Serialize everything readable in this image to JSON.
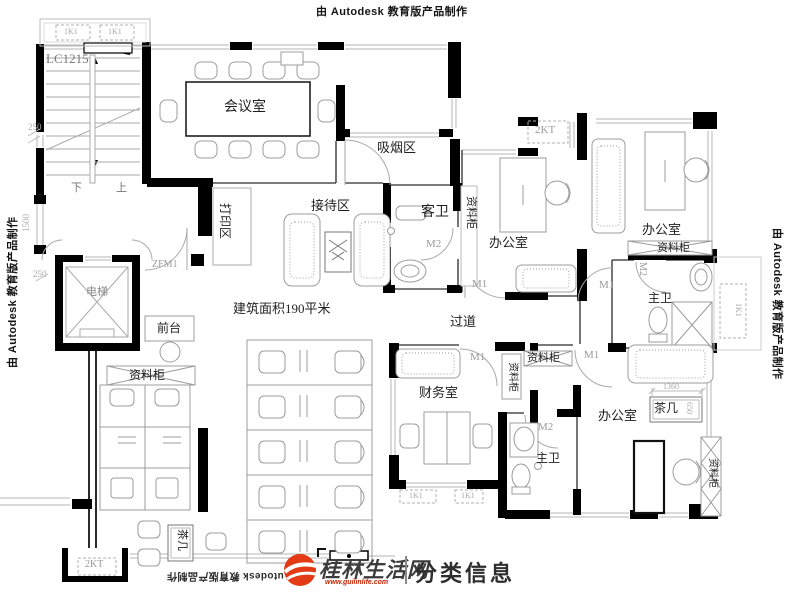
{
  "watermarks": {
    "autodesk_text": "由 Autodesk 教育版产品制作"
  },
  "logo": {
    "site_name": "桂林生活网",
    "site_url": "www.guilinlife.com",
    "tagline": "分类信息",
    "brand_red": "#e23b16"
  },
  "plan": {
    "area_note": "建筑面积190平米",
    "window_code": "LC1215",
    "labels": [
      {
        "id": "window-code-lc1215",
        "t": "LC1215",
        "x": 46,
        "y": 52,
        "s": 13,
        "c": "#777"
      },
      {
        "id": "room-conference",
        "t": "会议室",
        "x": 224,
        "y": 101,
        "s": 14
      },
      {
        "id": "area-smoking",
        "t": "吸烟区",
        "x": 377,
        "y": 141,
        "s": 13
      },
      {
        "id": "area-reception",
        "t": "接待区",
        "x": 311,
        "y": 199,
        "s": 13
      },
      {
        "id": "area-print",
        "t": "打印区",
        "x": 231,
        "y": 203,
        "s": 12,
        "r": 90
      },
      {
        "id": "door-zfm1",
        "t": "ZFM1",
        "x": 152,
        "y": 260,
        "s": 10,
        "c": "#999"
      },
      {
        "id": "room-guest-bath",
        "t": "客卫",
        "x": 421,
        "y": 206,
        "s": 14
      },
      {
        "id": "door-m2-guest-bath",
        "t": "M2",
        "x": 426,
        "y": 239,
        "s": 11,
        "c": "#999"
      },
      {
        "id": "elevator-label",
        "t": "电梯",
        "x": 86,
        "y": 287,
        "s": 11,
        "c": "#888"
      },
      {
        "id": "dim-250-upper",
        "t": "250",
        "x": 28,
        "y": 123,
        "s": 9,
        "c": "#aaa"
      },
      {
        "id": "dim-1500",
        "t": "1500",
        "x": 22,
        "y": 232,
        "s": 9,
        "c": "#aaa",
        "r": -90
      },
      {
        "id": "dim-250-lower",
        "t": "250",
        "x": 33,
        "y": 270,
        "s": 9,
        "c": "#aaa"
      },
      {
        "id": "stair-down",
        "t": "下",
        "x": 71,
        "y": 183,
        "s": 11,
        "c": "#777"
      },
      {
        "id": "stair-up",
        "t": "上",
        "x": 116,
        "y": 183,
        "s": 11,
        "c": "#777"
      },
      {
        "id": "front-desk-label",
        "t": "前台",
        "x": 157,
        "y": 322,
        "s": 12
      },
      {
        "id": "cabinet-lobby",
        "t": "资料柜",
        "x": 129,
        "y": 369,
        "s": 12
      },
      {
        "id": "area-note",
        "t": "建筑面积190平米",
        "x": 233,
        "y": 302,
        "s": 13
      },
      {
        "id": "corridor-label",
        "t": "过道",
        "x": 450,
        "y": 315,
        "s": 13
      },
      {
        "id": "room-office-1",
        "t": "办公室",
        "x": 489,
        "y": 236,
        "s": 13
      },
      {
        "id": "cabinet-office-1",
        "t": "资料柜",
        "x": 476,
        "y": 196,
        "s": 11,
        "r": 90
      },
      {
        "id": "ac-2kt-top",
        "t": "2KT",
        "x": 535,
        "y": 125,
        "s": 11,
        "c": "#999"
      },
      {
        "id": "room-office-2",
        "t": "办公室",
        "x": 642,
        "y": 223,
        "s": 13
      },
      {
        "id": "cabinet-office-2",
        "t": "资料柜",
        "x": 657,
        "y": 243,
        "s": 11
      },
      {
        "id": "door-m1-office-1",
        "t": "M1",
        "x": 472,
        "y": 279,
        "s": 11,
        "c": "#999"
      },
      {
        "id": "door-m1-bath-1",
        "t": "M1",
        "x": 599,
        "y": 280,
        "s": 11,
        "c": "#999"
      },
      {
        "id": "door-m2-bath-1",
        "t": "M2",
        "x": 647,
        "y": 262,
        "s": 10,
        "c": "#999",
        "r": 90
      },
      {
        "id": "room-master-bath-1",
        "t": "主卫",
        "x": 648,
        "y": 292,
        "s": 12
      },
      {
        "id": "door-m1-finance",
        "t": "M1",
        "x": 470,
        "y": 352,
        "s": 11,
        "c": "#999"
      },
      {
        "id": "room-finance",
        "t": "财务室",
        "x": 419,
        "y": 386,
        "s": 13
      },
      {
        "id": "cabinet-corridor-vert",
        "t": "资料柜",
        "x": 517,
        "y": 362,
        "s": 10,
        "r": 90
      },
      {
        "id": "cabinet-corridor-horiz",
        "t": "资料柜",
        "x": 527,
        "y": 353,
        "s": 11
      },
      {
        "id": "door-m1-corridor",
        "t": "M1",
        "x": 584,
        "y": 350,
        "s": 11,
        "c": "#999"
      },
      {
        "id": "door-m2-bath-2",
        "t": "M2",
        "x": 538,
        "y": 422,
        "s": 11,
        "c": "#999"
      },
      {
        "id": "room-master-bath-2",
        "t": "主卫",
        "x": 536,
        "y": 452,
        "s": 12
      },
      {
        "id": "room-office-3",
        "t": "办公室",
        "x": 598,
        "y": 409,
        "s": 13
      },
      {
        "id": "tea-table-office-3",
        "t": "茶几",
        "x": 654,
        "y": 402,
        "s": 12
      },
      {
        "id": "dim-1360",
        "t": "1360",
        "x": 663,
        "y": 383,
        "s": 8,
        "c": "#aaa"
      },
      {
        "id": "dim-650",
        "t": "650",
        "x": 693,
        "y": 402,
        "s": 8,
        "c": "#aaa",
        "r": 90
      },
      {
        "id": "cabinet-office-3",
        "t": "资料柜",
        "x": 717,
        "y": 458,
        "s": 10,
        "r": 90
      },
      {
        "id": "tea-table-lobby",
        "t": "茶几",
        "x": 187,
        "y": 529,
        "s": 11,
        "r": 90
      },
      {
        "id": "ac-2kt-bottom",
        "t": "2KT",
        "x": 85,
        "y": 560,
        "s": 10,
        "c": "#999"
      },
      {
        "id": "ac-1k1-balcony-a",
        "t": "1K1",
        "x": 64,
        "y": 28,
        "s": 8,
        "c": "#aaa"
      },
      {
        "id": "ac-1k1-balcony-b",
        "t": "1K1",
        "x": 108,
        "y": 28,
        "s": 8,
        "c": "#aaa"
      },
      {
        "id": "ac-1k1-right",
        "t": "1K1",
        "x": 742,
        "y": 303,
        "s": 8,
        "c": "#aaa",
        "r": 90
      },
      {
        "id": "ac-1k1-finance-a",
        "t": "1K1",
        "x": 409,
        "y": 492,
        "s": 8,
        "c": "#aaa"
      },
      {
        "id": "ac-1k1-finance-b",
        "t": "1K1",
        "x": 461,
        "y": 492,
        "s": 8,
        "c": "#aaa"
      }
    ]
  }
}
